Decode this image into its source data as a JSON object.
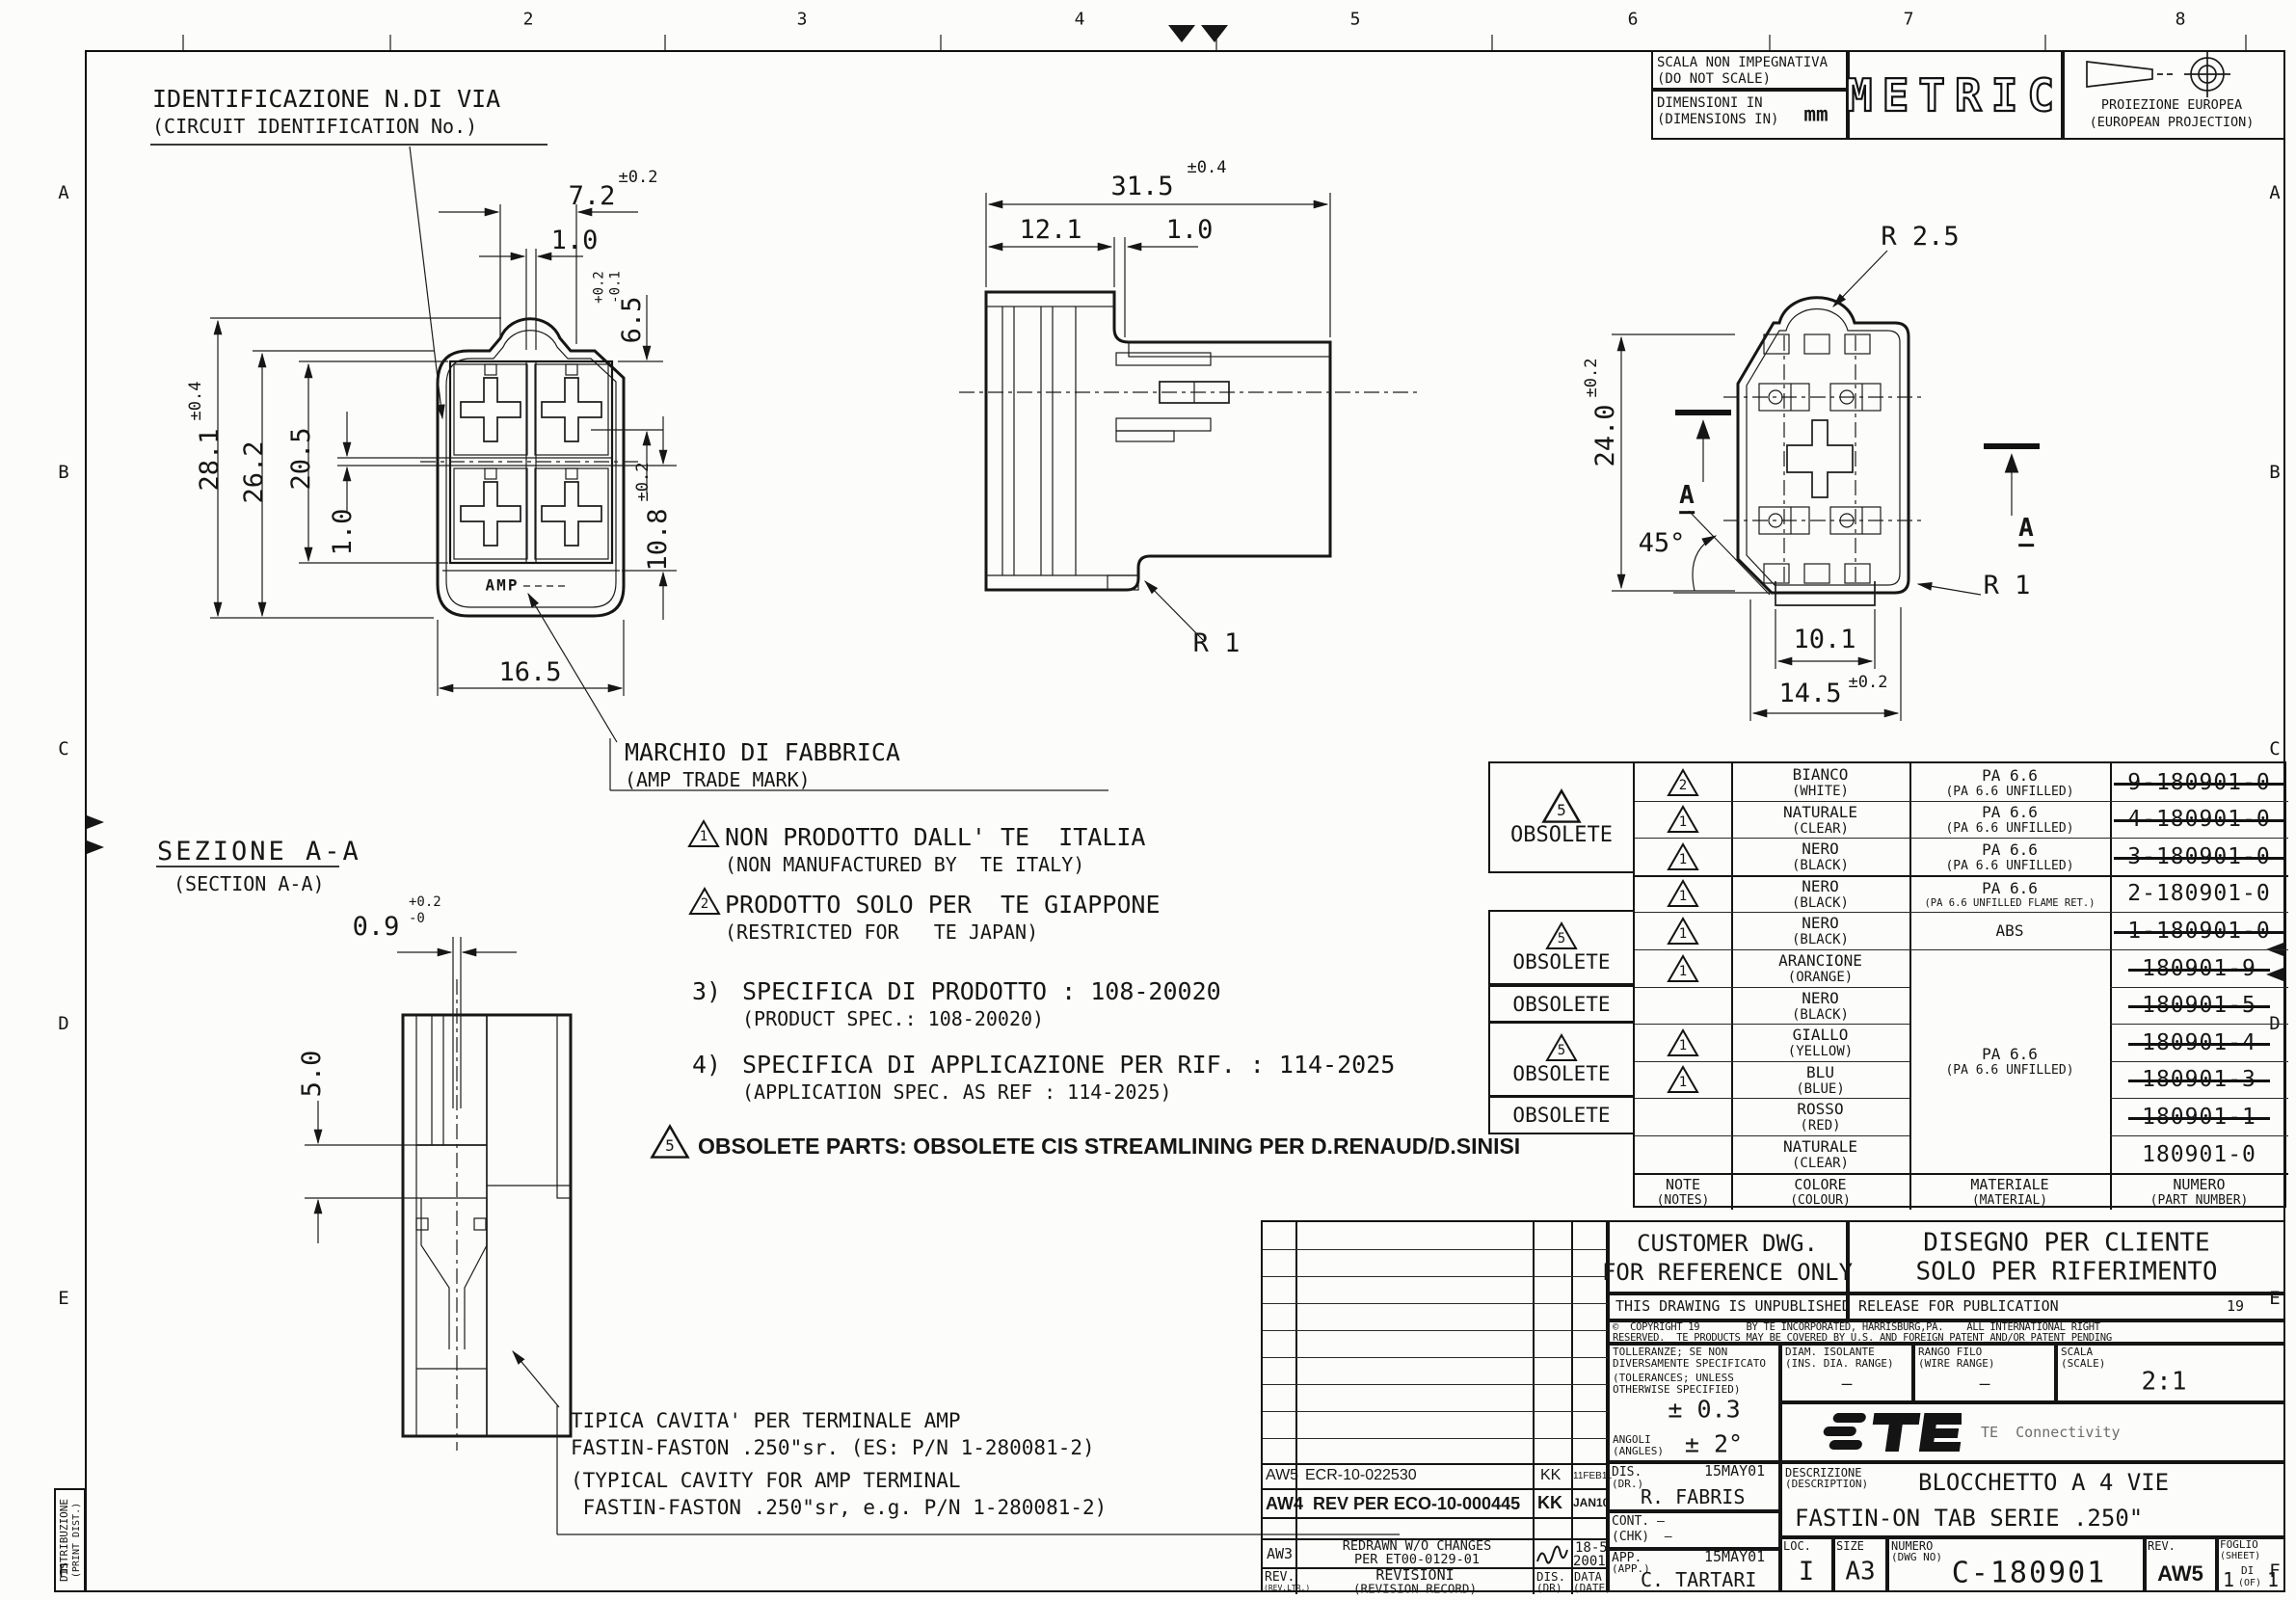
{
  "sheet": {
    "zones_top": [
      "2",
      "3",
      "4",
      "5",
      "6",
      "7",
      "8"
    ],
    "zones_side": [
      "A",
      "B",
      "C",
      "D",
      "E",
      "F"
    ]
  },
  "header": {
    "scala1": "SCALA NON IMPEGNATIVA",
    "scala2": "(DO NOT SCALE)",
    "dim1": "DIMENSIONI IN",
    "dim2": "(DIMENSIONS IN)",
    "unit": "mm",
    "metric": "METRIC",
    "proj1": "PROIEZIONE EUROPEA",
    "proj2": "(EUROPEAN PROJECTION)"
  },
  "views": {
    "front": {
      "circuit1": "IDENTIFICAZIONE N.DI VIA",
      "circuit2": "(CIRCUIT IDENTIFICATION No.)",
      "mark1": "MARCHIO DI FABBRICA",
      "mark2": "(AMP TRADE MARK)",
      "amp": "AMP",
      "w_bump": "7.2",
      "w_bump_tol": "±0.2",
      "rib": "1.0",
      "depth": "6.5",
      "depth_tol": "+0.2\n-0.1",
      "h_total": "28.1",
      "h_total_tol": "±0.4",
      "h_body": "26.2",
      "h_cavity": "20.5",
      "wall": "1.0",
      "h_lower": "10.8",
      "h_lower_tol": "±0.2",
      "width": "16.5"
    },
    "side": {
      "len": "31.5",
      "len_tol": "±0.4",
      "cap": "12.1",
      "wall": "1.0",
      "r1": "R 1"
    },
    "rear": {
      "r25": "R 2.5",
      "h": "24.0",
      "h_tol": "±0.2",
      "angle": "45°",
      "tab_w": "10.1",
      "base_w": "14.5",
      "base_w_tol": "±0.2",
      "r1": "R 1",
      "sec": "A"
    },
    "section": {
      "title": "SEZIONE A-A",
      "subtitle": "(SECTION A-A)",
      "slot": "0.9",
      "slot_tol": "+0.2\n-0",
      "depth": "5.0",
      "cavity1": "TIPICA CAVITA' PER TERMINALE AMP",
      "cavity2": "FASTIN-FASTON .250\"sr. (ES: P/N 1-280081-2)",
      "cavity3": "(TYPICAL CAVITY FOR AMP TERMINAL",
      "cavity4": " FASTIN-FASTON .250\"sr, e.g. P/N 1-280081-2)"
    }
  },
  "notes": {
    "n1m": "1",
    "n1a": "NON PRODOTTO DALL' TE  ITALIA",
    "n1b": "(NON MANUFACTURED BY  TE ITALY)",
    "n2m": "2",
    "n2a": "PRODOTTO SOLO PER  TE GIAPPONE",
    "n2b": "(RESTRICTED FOR   TE JAPAN)",
    "n3m": "3)",
    "n3a": "SPECIFICA DI PRODOTTO : 108-20020",
    "n3b": "(PRODUCT SPEC.: 108-20020)",
    "n4m": "4)",
    "n4a": "SPECIFICA DI APPLICAZIONE PER RIF. : 114-2025",
    "n4b": "(APPLICATION SPEC. AS REF : 114-2025)",
    "n5m": "5",
    "n5a": "OBSOLETE PARTS: OBSOLETE CIS STREAMLINING PER D.RENAUD/D.SINISI"
  },
  "parts_table": {
    "obsolete_label": "OBSOLETE",
    "note5": "5",
    "headers": {
      "note1": "NOTE",
      "note2": "(NOTES)",
      "color1": "COLORE",
      "color2": "(COLOUR)",
      "mat1": "MATERIALE",
      "mat2": "(MATERIAL)",
      "num1": "NUMERO",
      "num2": "(PART NUMBER)"
    },
    "merged": {
      "m1": "PA 6.6",
      "m2": "(PA 6.6 UNFILLED)"
    },
    "rows": [
      {
        "note": "2",
        "c1": "BIANCO",
        "c2": "(WHITE)",
        "m1": "PA 6.6",
        "m2": "(PA 6.6 UNFILLED)",
        "pn": "9-180901-0"
      },
      {
        "note": "1",
        "c1": "NATURALE",
        "c2": "(CLEAR)",
        "m1": "PA 6.6",
        "m2": "(PA 6.6 UNFILLED)",
        "pn": "4-180901-0"
      },
      {
        "note": "1",
        "c1": "NERO",
        "c2": "(BLACK)",
        "m1": "PA 6.6",
        "m2": "(PA 6.6 UNFILLED)",
        "pn": "3-180901-0"
      },
      {
        "note": "1",
        "c1": "NERO",
        "c2": "(BLACK)",
        "m1": "PA 6.6",
        "m2": "(PA 6.6 UNFILLED FLAME RET.)",
        "pn": "2-180901-0"
      },
      {
        "note": "1",
        "c1": "NERO",
        "c2": "(BLACK)",
        "m1": "ABS",
        "m2": "",
        "pn": "1-180901-0"
      },
      {
        "note": "1",
        "c1": "ARANCIONE",
        "c2": "(ORANGE)",
        "pn": "180901-9"
      },
      {
        "note": "",
        "c1": "NERO",
        "c2": "(BLACK)",
        "pn": "180901-5"
      },
      {
        "note": "1",
        "c1": "GIALLO",
        "c2": "(YELLOW)",
        "pn": "180901-4"
      },
      {
        "note": "1",
        "c1": "BLU",
        "c2": "(BLUE)",
        "pn": "180901-3"
      },
      {
        "note": "",
        "c1": "ROSSO",
        "c2": "(RED)",
        "pn": "180901-1"
      },
      {
        "note": "",
        "c1": "NATURALE",
        "c2": "(CLEAR)",
        "pn": "180901-0"
      }
    ]
  },
  "title_block": {
    "customer1": "CUSTOMER DWG.",
    "customer2": "FOR REFERENCE ONLY",
    "cliente1": "DISEGNO PER CLIENTE",
    "cliente2": "SOLO PER RIFERIMENTO",
    "unpublished": "THIS DRAWING IS UNPUBLISHED",
    "release": "RELEASE FOR PUBLICATION",
    "release_year": "19",
    "copy1": "©  COPYRIGHT 19        BY TE INCORPORATED, HARRISBURG,PA.    ALL INTERNATIONAL RIGHT",
    "copy2": "RESERVED.  TE PRODUCTS MAY BE COVERED BY U.S. AND FOREIGN PATENT AND/OR PATENT PENDING",
    "toll1": "TOLLERANZE; SE NON",
    "toll2": "DIVERSAMENTE SPECIFICATO",
    "toll3": "(TOLERANCES; UNLESS",
    "toll4": "OTHERWISE SPECIFIED)",
    "tol_val": "± 0.3",
    "ang1": "ANGOLI",
    "ang2": "(ANGLES)",
    "ang_val": "± 2°",
    "diam1": "DIAM. ISOLANTE",
    "diam2": "(INS. DIA. RANGE)",
    "diam_val": "—",
    "rango1": "RANGO FILO",
    "rango2": "(WIRE RANGE)",
    "rango_val": "—",
    "scala1": "SCALA",
    "scala2": "(SCALE)",
    "scala_val": "2:1",
    "te_conn": "TE  Connectivity",
    "dis1": "DIS.",
    "dis2": "(DR.)",
    "dis_name": "R. FABRIS",
    "dis_date": "15MAY01",
    "cont1": "CONT. —",
    "cont2": "(CHK)  —",
    "app1": "APP.",
    "app2": "(APP.)",
    "app_name": "C. TARTARI",
    "app_date": "15MAY01",
    "descr1": "DESCRIZIONE",
    "descr2": "(DESCRIPTION)",
    "descr_line1": "BLOCCHETTO A 4 VIE",
    "descr_line2": "FASTIN-ON TAB SERIE .250\"",
    "loc_label": "LOC.",
    "loc": "I",
    "size_label": "SIZE",
    "size": "A3",
    "num1": "NUMERO",
    "num2": "(DWG NO)",
    "dwg_no": "C-180901",
    "rev_label": "REV.",
    "rev": "AW5",
    "foglio1": "FOGLIO",
    "foglio2": "(SHEET)",
    "sheet_a": "1",
    "sheet_di": "DI",
    "sheet_of": "(OF)",
    "sheet_b": "1",
    "revisions": {
      "header": {
        "rev1": "REV.",
        "rev2": "(REV.LTR.)",
        "rec1": "REVISIONI",
        "rec2": "(REVISION RECORD)",
        "dis1": "DIS.",
        "dis2": "(DR)",
        "data1": "DATA",
        "data2": "(DATE)"
      },
      "rows": [
        {
          "rev": "AW5",
          "desc": "ECR-10-022530",
          "by": "KK",
          "date": "11FEB11"
        },
        {
          "rev": "AW4",
          "desc": "REV PER ECO-10-000445",
          "by": "KK",
          "date": "JAN10"
        },
        {
          "rev": "AW3",
          "desc1": "REDRAWN W/O CHANGES",
          "desc2": "PER ET00-0129-01",
          "date1": "18-5",
          "date2": "2001"
        }
      ]
    }
  },
  "distribution": {
    "line1": "DISTRIBUZIONE",
    "line2": "(PRINT DIST.)"
  }
}
